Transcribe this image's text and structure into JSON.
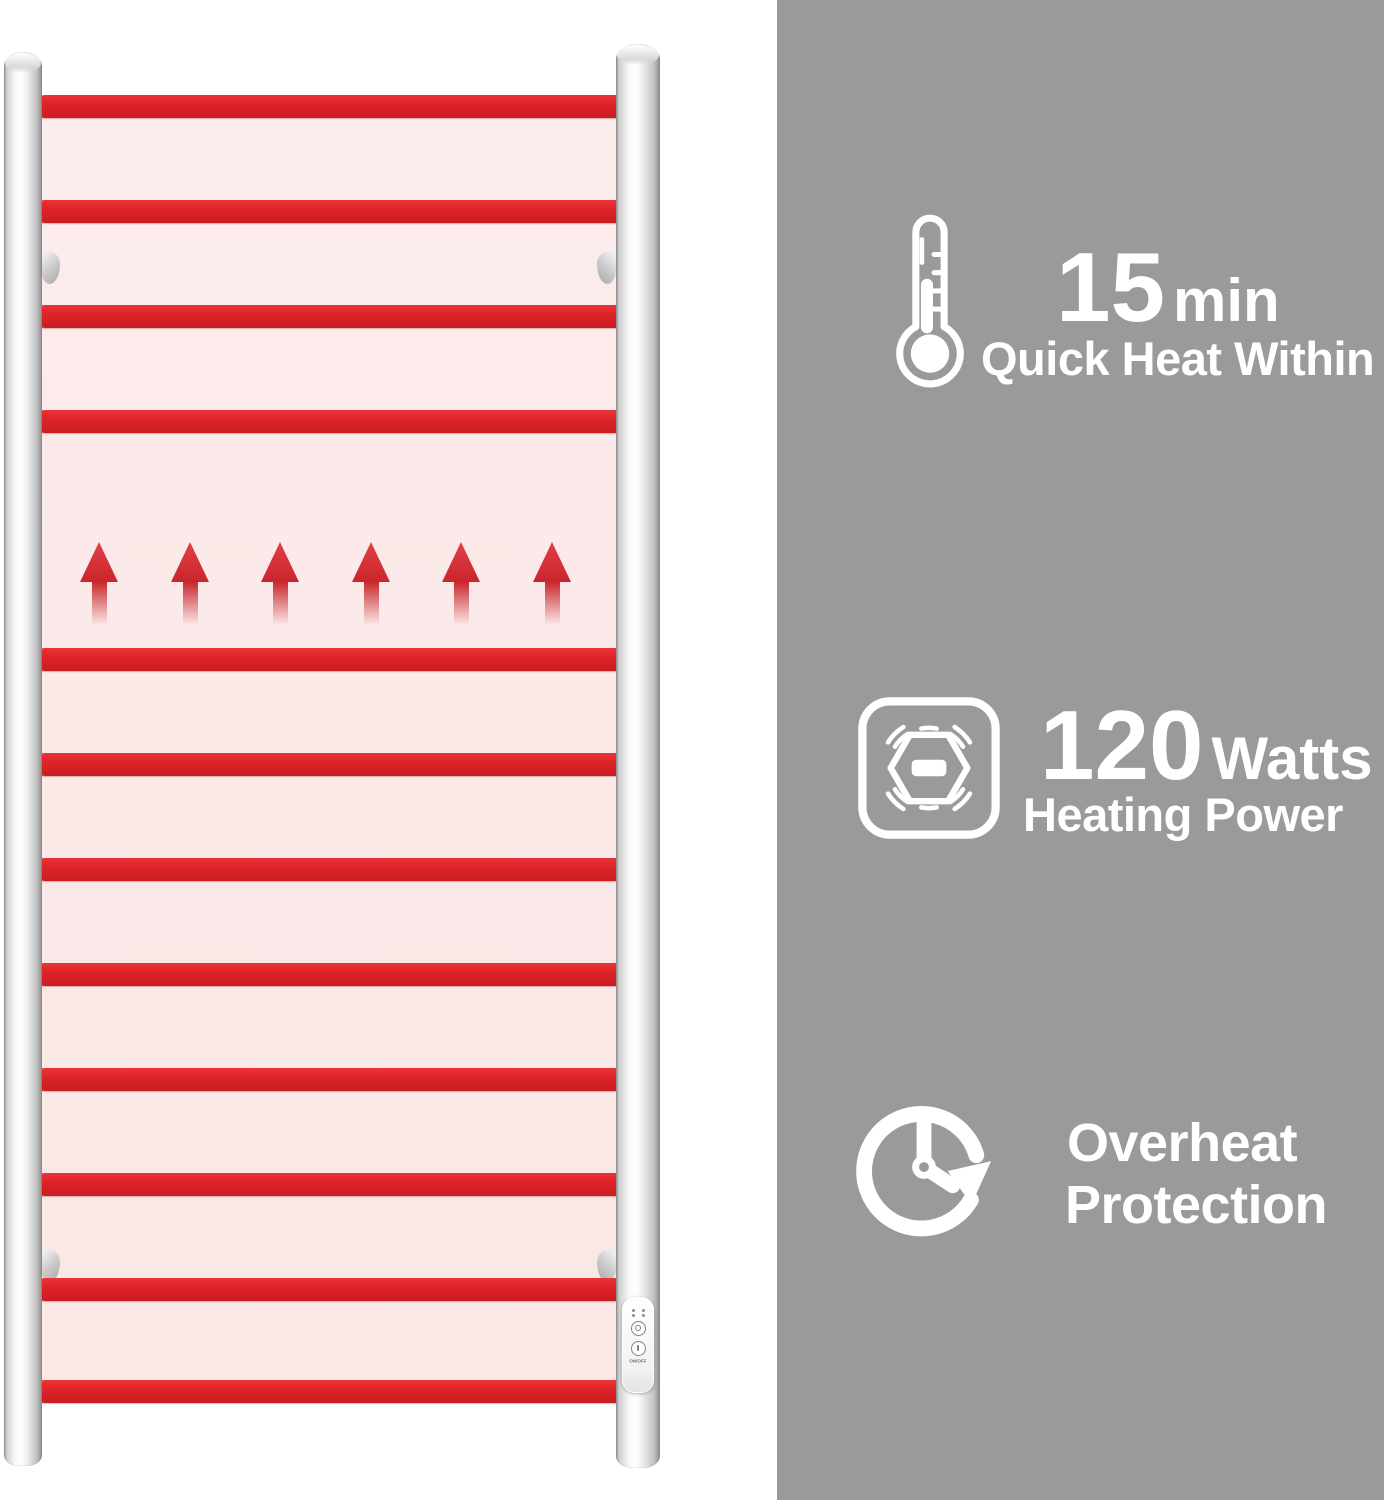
{
  "colors": {
    "background_white": "#ffffff",
    "panel_gray": "#9a9a9a",
    "bar_red": "#de2327",
    "glow_pink": "#fbe9e8",
    "chrome_silver": "#ececec",
    "text_white": "#ffffff"
  },
  "rack": {
    "bar_count": 12,
    "heat_arrow_count": 6,
    "wall_bracket_count": 4,
    "control_panel": {
      "label": "ON/OFF",
      "button_count": 2
    }
  },
  "features": [
    {
      "id": "quick-heat",
      "icon": "thermometer-icon",
      "value": "15",
      "unit": "min",
      "caption": "Quick Heat Within"
    },
    {
      "id": "heating-power",
      "icon": "heating-element-icon",
      "value": "120",
      "unit": "Watts",
      "caption": "Heating Power"
    },
    {
      "id": "overheat-protection",
      "icon": "timer-clock-icon",
      "caption_line1": "Overheat",
      "caption_line2": "Protection"
    }
  ]
}
